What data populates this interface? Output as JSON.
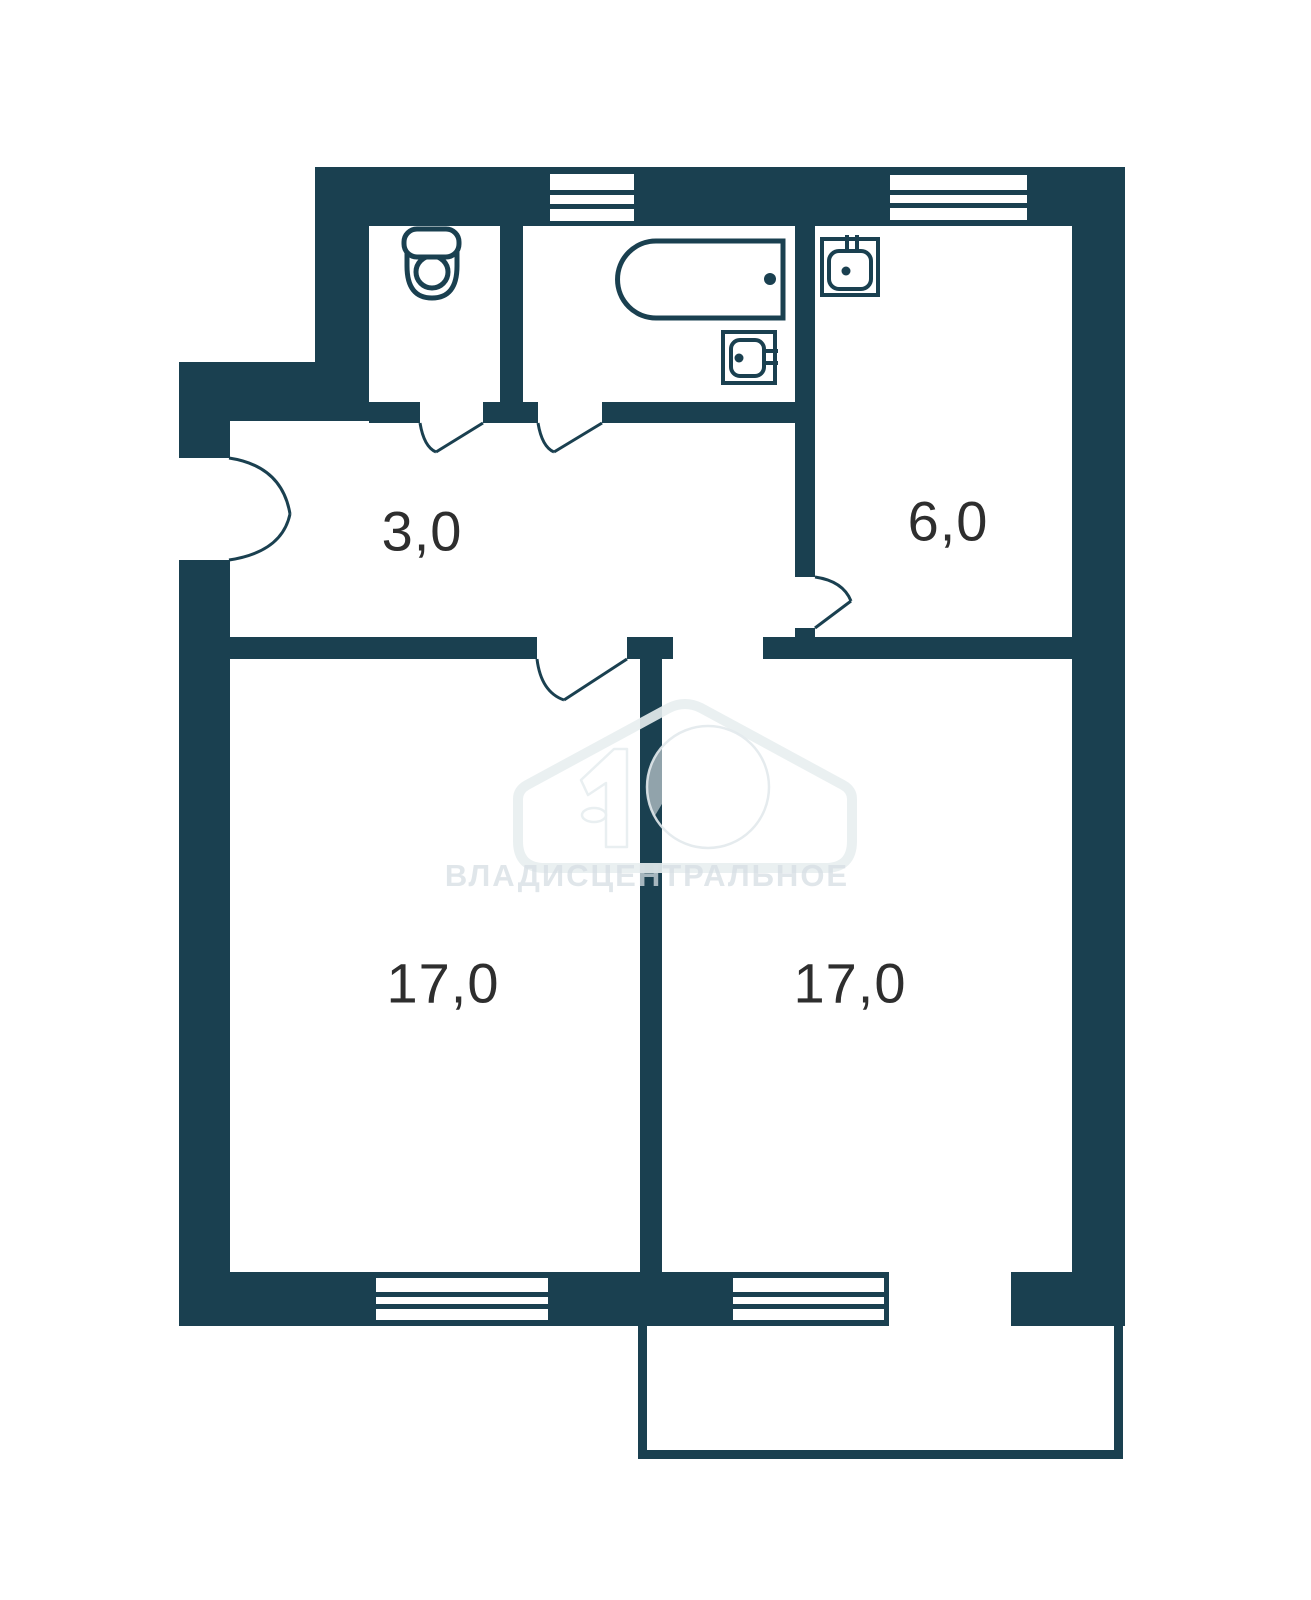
{
  "page": {
    "width": 1311,
    "height": 1600,
    "background": "#ffffff"
  },
  "colors": {
    "wall": "#1a4050",
    "label": "#2e2e2e",
    "fixture_fill": "#ffffff"
  },
  "rooms": [
    {
      "id": "hallway",
      "area_label": "3,0",
      "cx": 422,
      "cy": 531
    },
    {
      "id": "kitchen",
      "area_label": "6,0",
      "cx": 948,
      "cy": 521
    },
    {
      "id": "room-left",
      "area_label": "17,0",
      "cx": 443,
      "cy": 983
    },
    {
      "id": "room-right",
      "area_label": "17,0",
      "cx": 850,
      "cy": 983
    }
  ],
  "watermark": {
    "text": "ВЛАДИСЦЕНТРАЛЬНОЕ",
    "text_x": 647,
    "text_y": 886,
    "font_size": 31,
    "letter_spacing": 2,
    "text_fill": "rgba(213,222,227,0.75)",
    "house_path": "M518,841 L518,799 Q518,790 527,785 L669,708 Q685,700 701,708 L843,785 Q852,790 852,799 L852,841 Q852,868 825,868 L545,868 Q518,868 518,841 Z",
    "house_stroke": "rgba(232,238,240,0.9)",
    "house_stroke_width": 10,
    "disc": {
      "cx": 708,
      "cy": 787,
      "r": 61,
      "fill": "rgba(255,255,255,0.52)",
      "outline": "rgba(226,233,236,0.9)"
    },
    "chevron_path": "M645,849 L707,745 L786,850",
    "chevron_width": 17,
    "digit_path": "M581,780 L614,749 L627,749 L627,847 L606,847 L606,783 L588,795 Z",
    "digit_fill": "rgba(255,255,255,0.52)",
    "digit_outline": "rgba(232,238,240,0.95)",
    "ellipse": {
      "cx": 594,
      "cy": 815,
      "rx": 12,
      "ry": 7
    }
  },
  "geometry": {
    "walls": [
      {
        "n": "outer-wall-top",
        "x": 315,
        "y": 167,
        "w": 810,
        "h": 59
      },
      {
        "n": "outer-wall-left-upper",
        "x": 315,
        "y": 167,
        "w": 54,
        "h": 254
      },
      {
        "n": "outer-wall-step",
        "x": 179,
        "y": 362,
        "w": 190,
        "h": 59
      },
      {
        "n": "outer-wall-entry-upper",
        "x": 179,
        "y": 362,
        "w": 51,
        "h": 96
      },
      {
        "n": "outer-wall-left",
        "x": 179,
        "y": 560,
        "w": 51,
        "h": 766
      },
      {
        "n": "outer-wall-right",
        "x": 1072,
        "y": 167,
        "w": 53,
        "h": 1159
      },
      {
        "n": "wall-wc-bath-divider",
        "x": 500,
        "y": 226,
        "w": 23,
        "h": 176
      },
      {
        "n": "wall-wc-hall-a",
        "x": 369,
        "y": 402,
        "w": 51,
        "h": 21
      },
      {
        "n": "wall-wc-hall-b",
        "x": 483,
        "y": 402,
        "w": 55,
        "h": 21
      },
      {
        "n": "wall-bath-hall",
        "x": 602,
        "y": 402,
        "w": 193,
        "h": 21
      },
      {
        "n": "wall-kitchen-left",
        "x": 795,
        "y": 226,
        "w": 20,
        "h": 351
      },
      {
        "n": "wall-kitchen-left-stub",
        "x": 795,
        "y": 628,
        "w": 20,
        "h": 9
      },
      {
        "n": "wall-hall-room-left",
        "x": 230,
        "y": 637,
        "w": 307,
        "h": 22
      },
      {
        "n": "wall-mid-top-block",
        "x": 627,
        "y": 637,
        "w": 46,
        "h": 22
      },
      {
        "n": "wall-hall-room-right",
        "x": 763,
        "y": 637,
        "w": 309,
        "h": 22
      },
      {
        "n": "wall-between-rooms",
        "x": 640,
        "y": 659,
        "w": 22,
        "h": 613
      },
      {
        "n": "outer-wall-bottom-a",
        "x": 179,
        "y": 1272,
        "w": 191,
        "h": 54
      },
      {
        "n": "outer-wall-bottom-win1",
        "x": 370,
        "y": 1272,
        "w": 183,
        "h": 54
      },
      {
        "n": "outer-wall-bottom-b",
        "x": 553,
        "y": 1272,
        "w": 175,
        "h": 54
      },
      {
        "n": "outer-wall-bottom-win2",
        "x": 728,
        "y": 1272,
        "w": 161,
        "h": 54
      },
      {
        "n": "outer-wall-bottom-c",
        "x": 1011,
        "y": 1272,
        "w": 112,
        "h": 54
      },
      {
        "n": "balcony-wall-left",
        "x": 638,
        "y": 1326,
        "w": 9,
        "h": 133
      },
      {
        "n": "balcony-wall-right",
        "x": 1114,
        "y": 1326,
        "w": 9,
        "h": 133
      },
      {
        "n": "balcony-wall-bottom",
        "x": 638,
        "y": 1450,
        "w": 485,
        "h": 9
      }
    ],
    "windows": [
      {
        "n": "window-top-bathroom",
        "x": 550,
        "y": 174,
        "w": 84,
        "h": 47
      },
      {
        "n": "window-top-kitchen",
        "x": 890,
        "y": 175,
        "w": 137,
        "h": 45
      },
      {
        "n": "window-bottom-left-room",
        "x": 376,
        "y": 1278,
        "w": 172,
        "h": 42
      },
      {
        "n": "window-bottom-right-room",
        "x": 733,
        "y": 1278,
        "w": 151,
        "h": 42
      }
    ],
    "doors": [
      {
        "n": "entrance-door-leaf-upper",
        "d": "M229,458 Q282,466 290,514"
      },
      {
        "n": "entrance-door-leaf-lower",
        "d": "M229,560 Q282,552 290,514"
      },
      {
        "n": "wc-door-arc",
        "d": "M420,423 Q424,447 436,452"
      },
      {
        "n": "wc-door-leaf",
        "d": "M483,423 L436,452"
      },
      {
        "n": "bathroom-door-arc",
        "d": "M538,423 Q542,447 554,452"
      },
      {
        "n": "bathroom-door-leaf",
        "d": "M602,423 L554,452"
      },
      {
        "n": "left-room-door-arc",
        "d": "M537,659 Q541,692 564,700"
      },
      {
        "n": "left-room-door-leaf",
        "d": "M627,659 L564,700"
      },
      {
        "n": "kitchen-door-arc",
        "d": "M815,577 Q843,581 851,601"
      },
      {
        "n": "kitchen-door-leaf",
        "d": "M815,628 L851,601"
      }
    ],
    "fixtures": [
      {
        "n": "toilet-icon",
        "sw": 5,
        "shapes": [
          {
            "t": "path",
            "d": "M407,243 L457,243 L457,266 Q457,298 432,298 Q407,298 407,266 Z"
          },
          {
            "t": "circle",
            "cx": 432,
            "cy": 272,
            "r": 16
          },
          {
            "t": "rrect",
            "x": 404,
            "y": 229,
            "w": 55,
            "h": 28,
            "r": 13
          }
        ]
      },
      {
        "n": "bathtub-icon",
        "sw": 5,
        "shapes": [
          {
            "t": "path",
            "d": "M783,241 L656,241 A38.5,38.5 0 0 0 656,318 L783,318 Z"
          },
          {
            "t": "dot",
            "cx": 770,
            "cy": 279,
            "r": 6
          }
        ]
      },
      {
        "n": "bathroom-sink-icon",
        "sw": 4,
        "shapes": [
          {
            "t": "rect",
            "x": 723,
            "y": 332,
            "w": 52,
            "h": 51
          },
          {
            "t": "rrect",
            "x": 731,
            "y": 340,
            "w": 33,
            "h": 36,
            "r": 9
          },
          {
            "t": "dot",
            "cx": 739,
            "cy": 358,
            "r": 4.5
          },
          {
            "t": "line",
            "x1": 764,
            "y1": 351,
            "x2": 778,
            "y2": 351
          },
          {
            "t": "line",
            "x1": 764,
            "y1": 363,
            "x2": 778,
            "y2": 363
          }
        ]
      },
      {
        "n": "kitchen-sink-icon",
        "sw": 4,
        "shapes": [
          {
            "t": "rect",
            "x": 822,
            "y": 239,
            "w": 56,
            "h": 56
          },
          {
            "t": "rrect",
            "x": 829,
            "y": 251,
            "w": 42,
            "h": 38,
            "r": 10
          },
          {
            "t": "dot",
            "cx": 846,
            "cy": 271,
            "r": 4.5
          },
          {
            "t": "line",
            "x1": 847,
            "y1": 235,
            "x2": 847,
            "y2": 252
          },
          {
            "t": "line",
            "x1": 857,
            "y1": 235,
            "x2": 857,
            "y2": 252
          }
        ]
      }
    ]
  }
}
